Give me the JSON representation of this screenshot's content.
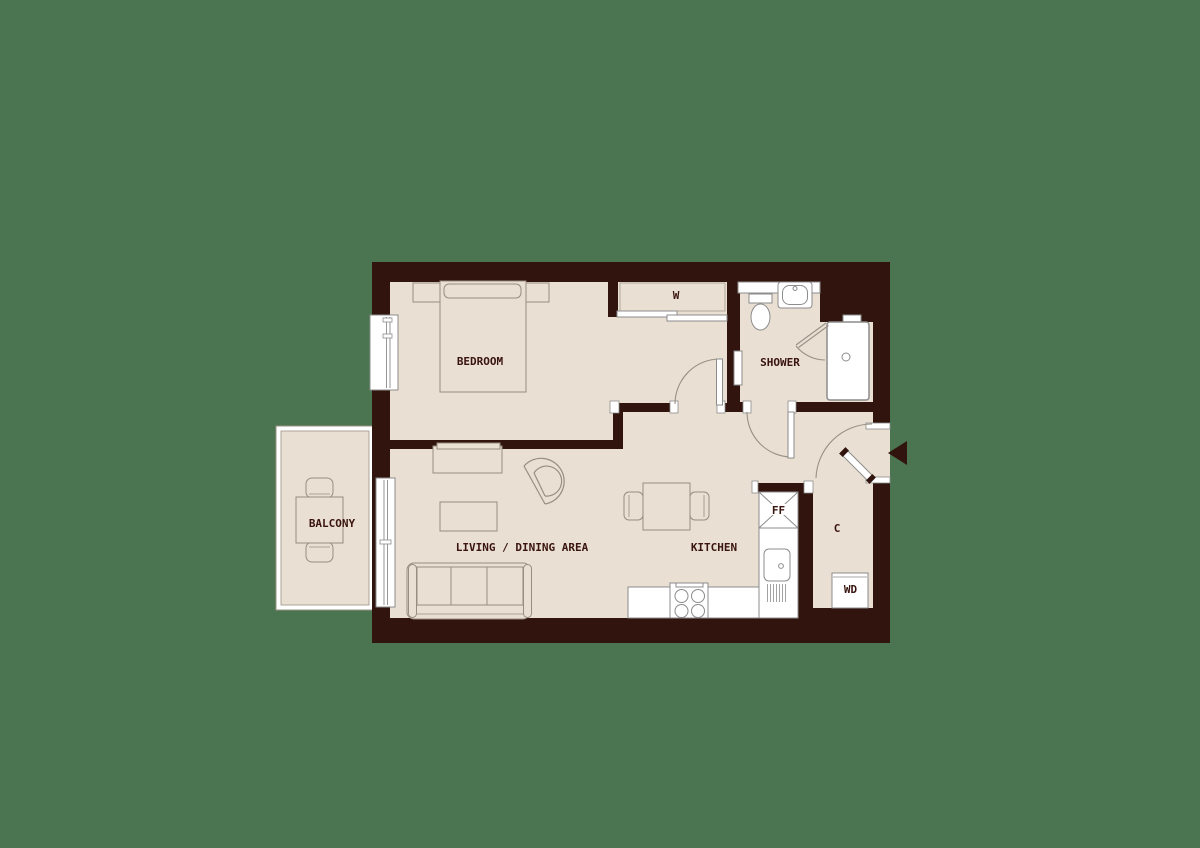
{
  "scene": {
    "type": "apartment-floor-plan",
    "colors": {
      "background": "#4a7550",
      "wall": "#30140d",
      "floor": "#e9dfd2",
      "fixture": "#ffffff",
      "furniture_outline": "#988d80",
      "label": "#3a140e"
    }
  },
  "rooms": {
    "bedroom": {
      "label": "BEDROOM"
    },
    "wardrobe": {
      "label": "W"
    },
    "shower": {
      "label": "SHOWER"
    },
    "living": {
      "label": "LIVING / DINING AREA"
    },
    "kitchen": {
      "label": "KITCHEN"
    },
    "balcony": {
      "label": "BALCONY"
    },
    "fridge_freezer": {
      "label": "FF"
    },
    "cupboard": {
      "label": "C"
    },
    "washer_dryer": {
      "label": "WD"
    }
  }
}
